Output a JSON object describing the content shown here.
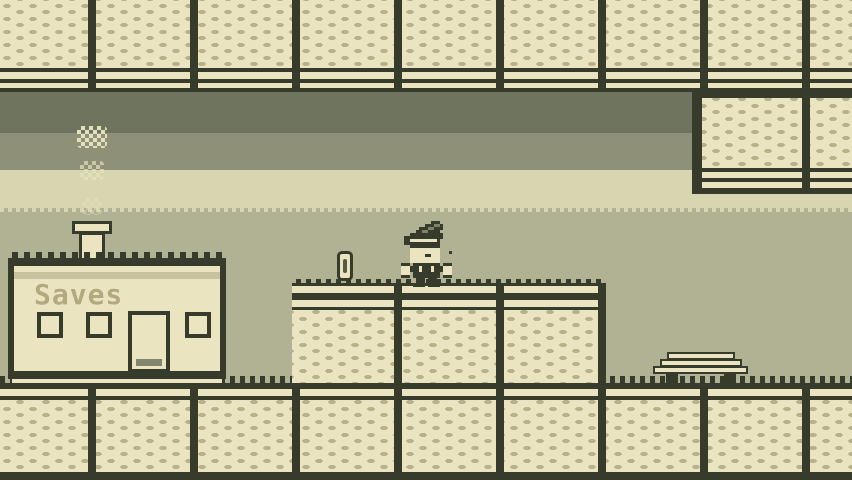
{
  "meta": {
    "scene_label": "gameboy-style pixel platformer scene",
    "visible_text": [
      "Saves"
    ]
  },
  "palette": {
    "ink": "#373b2b",
    "cream": "#eae4c1",
    "tex": "#b9b189",
    "bg": "#b1b193",
    "band1": "#6f745e",
    "band2": "#8e9178",
    "band3": "#d8d5b1",
    "tan": "#c9c29e",
    "gray": "#82866e",
    "sign": "#b2aa7e",
    "slit": "#565b41",
    "hatshade": "#7d8168"
  },
  "scene": {
    "sign_text": "Saves",
    "entities": {
      "save_house": {
        "label": "Saves",
        "windows": 3,
        "doors": 1,
        "chimney": true,
        "smoke_puffs": 3
      },
      "player": {
        "state": "standing-on-platform"
      },
      "coin": {
        "count": 1
      },
      "bench": {
        "count": 1
      },
      "platform_blocks": 3
    }
  }
}
